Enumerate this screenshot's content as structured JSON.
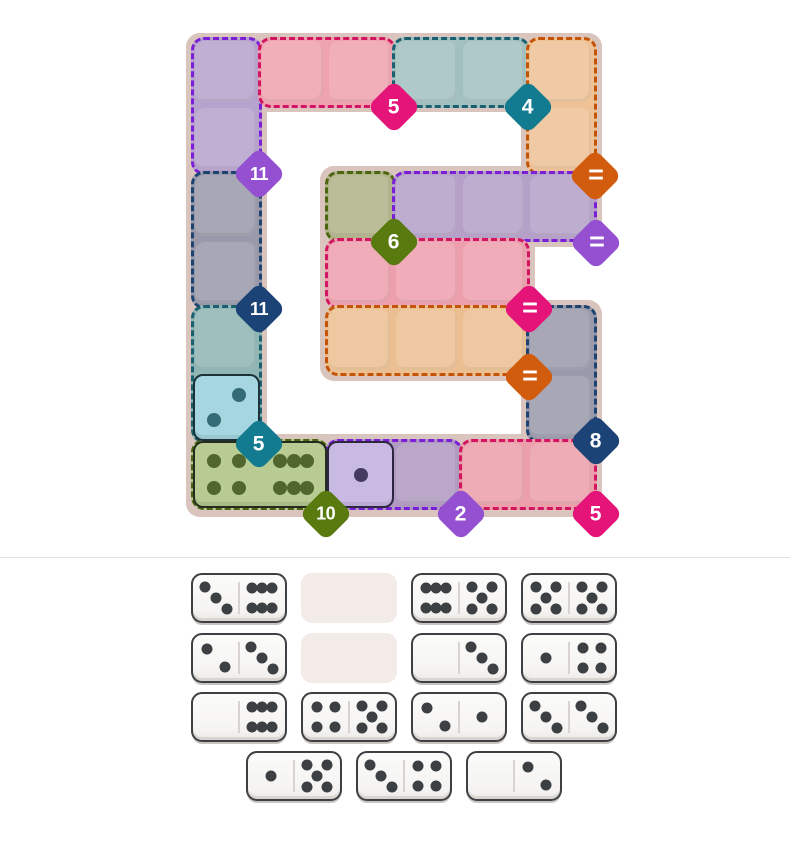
{
  "app": {
    "title": "Domino Sum Puzzle"
  },
  "colors": {
    "page_bg": "#ffffff",
    "board_bg": "#d9c5bd",
    "divider": "#e0e0e0",
    "badge_magenta": "#e41479",
    "badge_teal": "#127b90",
    "badge_purple": "#9550d2",
    "badge_navy": "#1c4376",
    "badge_orange": "#d25c0e",
    "badge_olive": "#587a0e"
  },
  "board": {
    "grid": {
      "x0": 195,
      "y0": 41,
      "cell": 63,
      "pitch": 67
    },
    "shape_rects": [
      {
        "x": 186,
        "y": 33,
        "w": 416,
        "h": 79
      },
      {
        "x": 186,
        "y": 33,
        "w": 81,
        "h": 484
      },
      {
        "x": 521,
        "y": 33,
        "w": 81,
        "h": 147
      },
      {
        "x": 320,
        "y": 166,
        "w": 282,
        "h": 81
      },
      {
        "x": 320,
        "y": 166,
        "w": 215,
        "h": 215
      },
      {
        "x": 521,
        "y": 300,
        "w": 81,
        "h": 217
      },
      {
        "x": 186,
        "y": 434,
        "w": 416,
        "h": 83
      }
    ],
    "regions": [
      {
        "name": "purple-top-left",
        "col": 0,
        "row": 0,
        "cols": 1,
        "rows": 2,
        "fill": "#b6a2cc",
        "border": "#7a1ed8"
      },
      {
        "name": "pink-top",
        "col": 1,
        "row": 0,
        "cols": 2,
        "rows": 1,
        "fill": "#efa2af",
        "border": "#d21560"
      },
      {
        "name": "teal-top",
        "col": 3,
        "row": 0,
        "cols": 2,
        "rows": 1,
        "fill": "#a2c0bf",
        "border": "#1b6070"
      },
      {
        "name": "orange-top-right",
        "col": 5,
        "row": 0,
        "cols": 1,
        "rows": 2,
        "fill": "#eec295",
        "border": "#c35305"
      },
      {
        "name": "gray-left",
        "col": 0,
        "row": 2,
        "cols": 1,
        "rows": 2,
        "fill": "#9a99ab",
        "border": "#1d4470"
      },
      {
        "name": "olive-single",
        "col": 2,
        "row": 2,
        "cols": 1,
        "rows": 1,
        "fill": "#b0b287",
        "border": "#4c660f"
      },
      {
        "name": "purple-mid",
        "col": 3,
        "row": 2,
        "cols": 3,
        "rows": 1,
        "fill": "#b5a0c8",
        "border": "#7a1ed8"
      },
      {
        "name": "pink-mid",
        "col": 2,
        "row": 3,
        "cols": 3,
        "rows": 1,
        "fill": "#ee9fad",
        "border": "#d21560"
      },
      {
        "name": "orange-mid",
        "col": 2,
        "row": 4,
        "cols": 3,
        "rows": 1,
        "fill": "#ecbf92",
        "border": "#c35305"
      },
      {
        "name": "gray-right",
        "col": 5,
        "row": 4,
        "cols": 1,
        "rows": 2,
        "fill": "#9a99ab",
        "border": "#1d4470"
      },
      {
        "name": "teal-left",
        "col": 0,
        "row": 4,
        "cols": 1,
        "rows": 2,
        "fill": "#8fb5b4",
        "border": "#1b6070"
      },
      {
        "name": "olive-bottom",
        "col": 0,
        "row": 6,
        "cols": 2,
        "rows": 1,
        "fill": "#b9c795",
        "border": "#4c660f"
      },
      {
        "name": "purple-bottom",
        "col": 2,
        "row": 6,
        "cols": 2,
        "rows": 1,
        "fill": "#b09ac1",
        "border": "#7a1ed8"
      },
      {
        "name": "pink-bottom",
        "col": 4,
        "row": 6,
        "cols": 2,
        "rows": 1,
        "fill": "#ec9fab",
        "border": "#d21560"
      }
    ],
    "placed_tiles": [
      {
        "name": "tile-blue-2",
        "col": 0,
        "row": 5,
        "cols": 1,
        "rows": 1,
        "fill": "#a6d7e1",
        "border": "#1b3238",
        "pip_color": "#336b77",
        "faces": [
          "2alt"
        ]
      },
      {
        "name": "tile-green-4-6",
        "col": 0,
        "row": 6,
        "cols": 2,
        "rows": 1,
        "fill": "#b8cb92",
        "border": "#252b1d",
        "pip_color": "#50662e",
        "faces": [
          "4",
          "6"
        ]
      },
      {
        "name": "tile-purple-1",
        "col": 2,
        "row": 6,
        "cols": 1,
        "rows": 1,
        "fill": "#c9bae3",
        "border": "#2c2640",
        "pip_color": "#453b60",
        "faces": [
          "1"
        ]
      }
    ],
    "badges": [
      {
        "label": "5",
        "color": "#e41479",
        "x": 394,
        "y": 107
      },
      {
        "label": "4",
        "color": "#127b90",
        "x": 528,
        "y": 107
      },
      {
        "label": "11",
        "color": "#9550d2",
        "x": 259,
        "y": 174
      },
      {
        "label": "=",
        "color": "#d25c0e",
        "x": 595,
        "y": 176
      },
      {
        "label": "6",
        "color": "#587a0e",
        "x": 394,
        "y": 242
      },
      {
        "label": "=",
        "color": "#9550d2",
        "x": 596,
        "y": 243
      },
      {
        "label": "11",
        "color": "#1c4376",
        "x": 259,
        "y": 309
      },
      {
        "label": "=",
        "color": "#e41479",
        "x": 529,
        "y": 309
      },
      {
        "label": "=",
        "color": "#d25c0e",
        "x": 529,
        "y": 377
      },
      {
        "label": "8",
        "color": "#1c4376",
        "x": 596,
        "y": 441
      },
      {
        "label": "5",
        "color": "#127b90",
        "x": 259,
        "y": 444
      },
      {
        "label": "10",
        "color": "#587a0e",
        "x": 326,
        "y": 514
      },
      {
        "label": "2",
        "color": "#9550d2",
        "x": 461,
        "y": 514
      },
      {
        "label": "5",
        "color": "#e41479",
        "x": 596,
        "y": 514
      }
    ]
  },
  "tray": {
    "divider_y": 557,
    "slot": {
      "w": 96,
      "h": 50,
      "empty_fill": "#f2ebe8"
    },
    "pip_color": "#3d4043",
    "rows": [
      {
        "x": 191,
        "y": 573,
        "slots": [
          {
            "type": "domino",
            "faces": [
              "3",
              "6"
            ]
          },
          {
            "type": "empty"
          },
          {
            "type": "domino",
            "faces": [
              "6",
              "5"
            ]
          },
          {
            "type": "domino",
            "faces": [
              "5",
              "5"
            ]
          }
        ]
      },
      {
        "x": 191,
        "y": 633,
        "slots": [
          {
            "type": "domino",
            "faces": [
              "2",
              "3"
            ]
          },
          {
            "type": "empty"
          },
          {
            "type": "domino",
            "faces": [
              "0",
              "3"
            ]
          },
          {
            "type": "domino",
            "faces": [
              "1",
              "4"
            ]
          }
        ]
      },
      {
        "x": 191,
        "y": 692,
        "slots": [
          {
            "type": "domino",
            "faces": [
              "0",
              "6"
            ]
          },
          {
            "type": "domino",
            "faces": [
              "4",
              "5"
            ]
          },
          {
            "type": "domino",
            "faces": [
              "2",
              "1"
            ]
          },
          {
            "type": "domino",
            "faces": [
              "3",
              "3"
            ]
          }
        ]
      },
      {
        "x": 246,
        "y": 751,
        "slots": [
          {
            "type": "domino",
            "faces": [
              "1",
              "5"
            ]
          },
          {
            "type": "domino",
            "faces": [
              "3",
              "4"
            ]
          },
          {
            "type": "domino",
            "faces": [
              "0",
              "2"
            ]
          }
        ]
      }
    ]
  }
}
